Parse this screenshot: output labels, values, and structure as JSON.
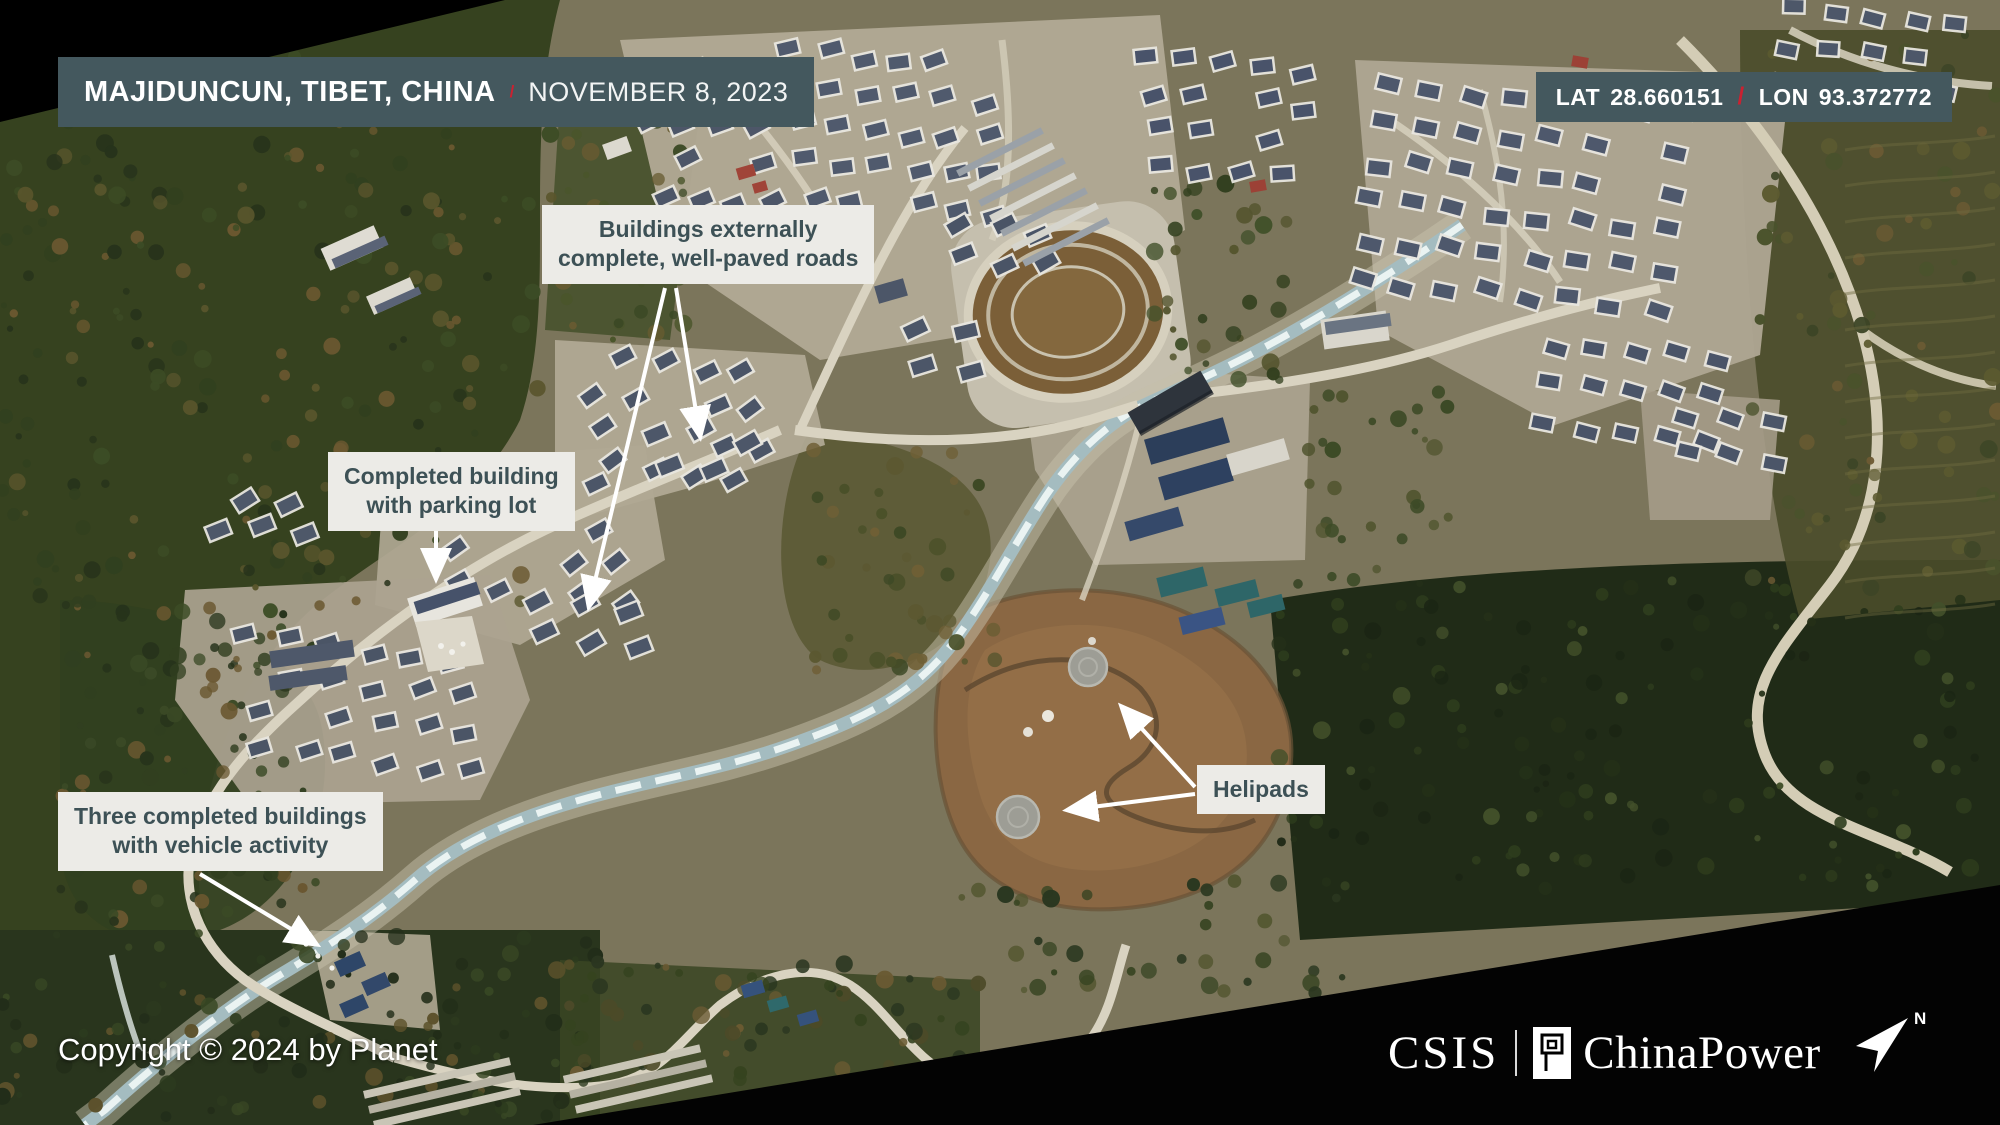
{
  "location_bar": {
    "location": "MAJIDUNCUN, TIBET, CHINA",
    "separator": "/",
    "date": "NOVEMBER 8, 2023"
  },
  "coords_bar": {
    "lat_label": "LAT",
    "lat_value": "28.660151",
    "separator": "/",
    "lon_label": "LON",
    "lon_value": "93.372772"
  },
  "annotations": {
    "buildings_complete": {
      "line1": "Buildings externally",
      "line2": "complete, well-paved roads"
    },
    "completed_building": {
      "line1": "Completed building",
      "line2": "with parking lot"
    },
    "three_buildings": {
      "line1": "Three completed buildings",
      "line2": "with vehicle activity"
    },
    "helipads": {
      "line1": "Helipads"
    }
  },
  "footer": {
    "copyright": "Copyright © 2024 by Planet",
    "brand_csis": "CSIS",
    "brand_chinapower": "ChinaPower",
    "north_label": "N"
  },
  "colors": {
    "panel_teal": "#44585e",
    "accent_red": "#cb2130",
    "annotation_bg": "#ecebe7",
    "annotation_text": "#3d5156"
  }
}
